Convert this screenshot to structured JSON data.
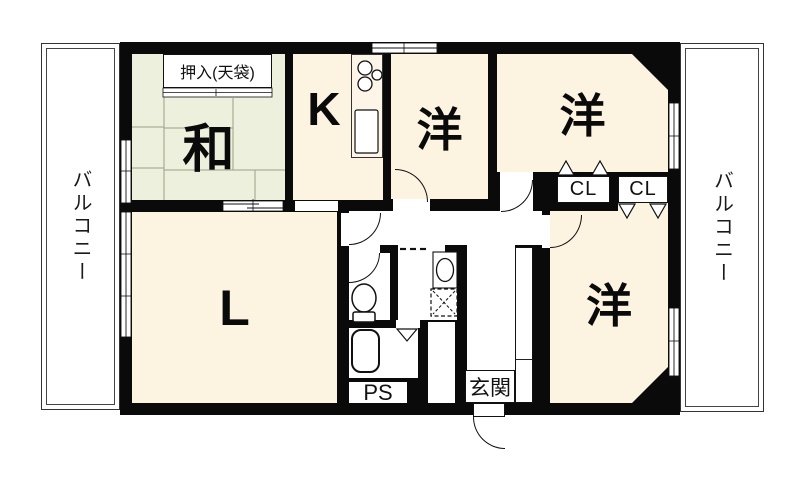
{
  "plan": {
    "balconies": {
      "left": "バルコニー",
      "right": "バルコニー"
    },
    "rooms": {
      "washitsu": "和",
      "kitchen": "K",
      "western_top_mid": "洋",
      "western_top_right": "洋",
      "western_bottom_right": "洋",
      "living": "L"
    },
    "features": {
      "oshiire": "押入(天袋)",
      "closet_1": "CL",
      "closet_2": "CL",
      "pipe_space": "PS",
      "entrance": "玄関"
    },
    "colors": {
      "cream": "#fcf3e1",
      "tatami": "#edf0dc",
      "wall": "#0a0a0a"
    }
  }
}
